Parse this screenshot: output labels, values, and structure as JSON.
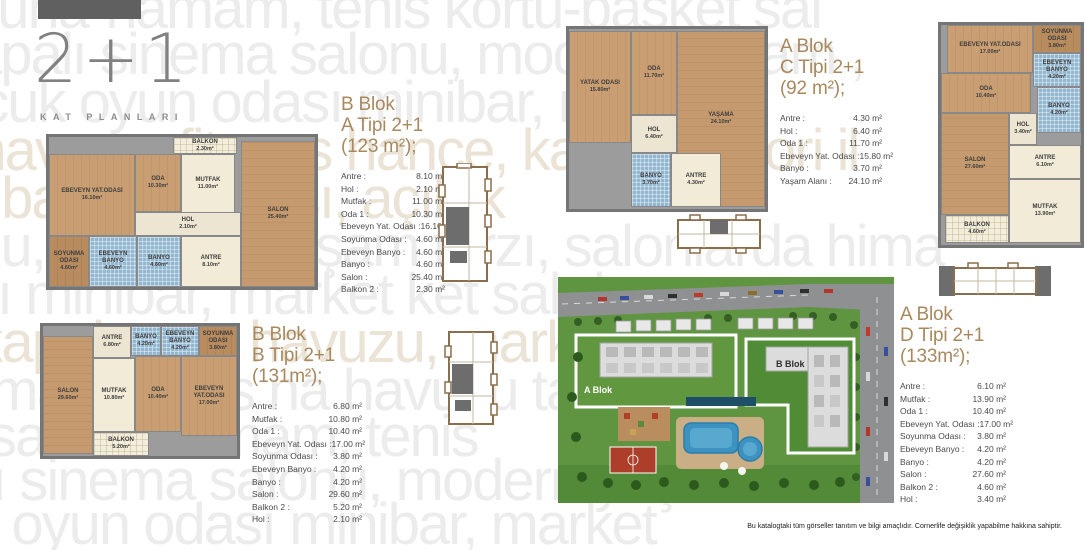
{
  "brand": {
    "title": "2+1",
    "subtitle": "KAT PLANLARI"
  },
  "watermark": {
    "lines": [
      "sauna-hamam, tenis kortu-basket sal",
      "apalı sinema salonu, modern yaşam ,",
      "ocuk oyun odası minibar, mer",
      "e havuzu, fitness hance, kapalı otolori il",
      "k basket sahası, açık-k",
      "onu, modern yaşam tarzı, salonlarda hima",
      "sı minibar, market ket sah kam",
      "k-kapalı zme havuzu, market, ket saha",
      "amam, tenis na havuzu tarzı sal",
      "ss sauna-hamam, tenis",
      "alı sinema salonu, modern yaşam",
      "uk oyun odası minibar, market"
    ]
  },
  "units": [
    {
      "block": "B Blok",
      "type": "A Tipi 2+1 (123 m²);",
      "rooms": [
        {
          "label": "Antre :",
          "value": "8.10 m²"
        },
        {
          "label": "Hol :",
          "value": "2.10 m²"
        },
        {
          "label": "Mutfak :",
          "value": "11.00 m²"
        },
        {
          "label": "Oda 1 :",
          "value": "10.30 m²"
        },
        {
          "label": "Ebeveyn Yat. Odası :",
          "value": "16.10 m²"
        },
        {
          "label": "Soyunma Odası :",
          "value": "4.60 m²"
        },
        {
          "label": "Ebeveyn Banyo :",
          "value": "4.60 m²"
        },
        {
          "label": "Banyo :",
          "value": "4.60 m²"
        },
        {
          "label": "Salon :",
          "value": "25.40 m²"
        },
        {
          "label": "Balkon 2 :",
          "value": "2.30 m²"
        }
      ]
    },
    {
      "block": "A Blok",
      "type": "C Tipi 2+1 (92 m²);",
      "rooms": [
        {
          "label": "Antre :",
          "value": "4.30 m²"
        },
        {
          "label": "Hol :",
          "value": "6.40 m²"
        },
        {
          "label": "Oda 1 :",
          "value": "11.70 m²"
        },
        {
          "label": "Ebeveyn Yat. Odası :",
          "value": "15.80 m²"
        },
        {
          "label": "Banyo :",
          "value": "3.70 m²"
        },
        {
          "label": "Yaşam Alanı :",
          "value": "24.10 m²"
        }
      ]
    },
    {
      "block": "B Blok",
      "type": "B Tipi 2+1 (131m²);",
      "rooms": [
        {
          "label": "Antre :",
          "value": "6.80 m²"
        },
        {
          "label": "Mutfak :",
          "value": "10.80 m²"
        },
        {
          "label": "Oda 1 :",
          "value": "10.40 m²"
        },
        {
          "label": "Ebeveyn Yat. Odası :",
          "value": "17.00 m²"
        },
        {
          "label": "Soyunma Odası :",
          "value": "3.80 m²"
        },
        {
          "label": "Ebeveyn Banyo :",
          "value": "4.20 m²"
        },
        {
          "label": "Banyo :",
          "value": "4.20 m²"
        },
        {
          "label": "Salon :",
          "value": "29.60 m²"
        },
        {
          "label": "Balkon 2 :",
          "value": "5.20 m²"
        },
        {
          "label": "Hol :",
          "value": "2.10 m²"
        }
      ]
    },
    {
      "block": "A Blok",
      "type": "D Tipi 2+1 (133m²);",
      "rooms": [
        {
          "label": "Antre :",
          "value": "6.10 m²"
        },
        {
          "label": "Mutfak :",
          "value": "13.90 m²"
        },
        {
          "label": "Oda 1 :",
          "value": "10.40 m²"
        },
        {
          "label": "Ebeveyn Yat. Odası :",
          "value": "17.00 m²"
        },
        {
          "label": "Soyunma Odası :",
          "value": "3.80 m²"
        },
        {
          "label": "Ebeveyn Banyo :",
          "value": "4.20 m²"
        },
        {
          "label": "Banyo :",
          "value": "4.20 m²"
        },
        {
          "label": "Salon :",
          "value": "27.60 m²"
        },
        {
          "label": "Balkon 2 :",
          "value": "4.60 m²"
        },
        {
          "label": "Hol :",
          "value": "3.40 m²"
        }
      ]
    }
  ],
  "plans": [
    {
      "name": "B Blok A Tipi plan",
      "rooms": [
        {
          "name": "BALKON",
          "area": "2.30m²"
        },
        {
          "name": "EBEVEYN YAT.ODASI",
          "area": "16.10m²"
        },
        {
          "name": "ODA",
          "area": "10.30m²"
        },
        {
          "name": "MUTFAK",
          "area": "11.00m²"
        },
        {
          "name": "SALON",
          "area": "25.40m²"
        },
        {
          "name": "HOL",
          "area": "2.10m²"
        },
        {
          "name": "SOYUNMA ODASI",
          "area": "4.60m²"
        },
        {
          "name": "EBEVEYN BANYO",
          "area": "4.60m²"
        },
        {
          "name": "BANYO",
          "area": "4.60m²"
        },
        {
          "name": "ANTRE",
          "area": "8.10m²"
        }
      ]
    },
    {
      "name": "A Blok C Tipi plan",
      "rooms": [
        {
          "name": "YATAK ODASI",
          "area": "15.80m²"
        },
        {
          "name": "ODA",
          "area": "11.70m²"
        },
        {
          "name": "YAŞAMA",
          "area": "24.10m²"
        },
        {
          "name": "HOL",
          "area": "6.40m²"
        },
        {
          "name": "BANYO",
          "area": "3.70m²"
        },
        {
          "name": "ANTRE",
          "area": "4.30m²"
        }
      ]
    },
    {
      "name": "A Blok D Tipi plan",
      "rooms": [
        {
          "name": "EBEVEYN YAT.ODASI",
          "area": "17.00m²"
        },
        {
          "name": "SOYUNMA ODASI",
          "area": "3.80m²"
        },
        {
          "name": "EBEVEYN BANYO",
          "area": "4.20m²"
        },
        {
          "name": "ODA",
          "area": "10.40m²"
        },
        {
          "name": "HOL",
          "area": "3.40m²"
        },
        {
          "name": "BANYO",
          "area": "4.20m²"
        },
        {
          "name": "SALON",
          "area": "27.60m²"
        },
        {
          "name": "ANTRE",
          "area": "6.10m²"
        },
        {
          "name": "MUTFAK",
          "area": "13.90m²"
        },
        {
          "name": "BALKON",
          "area": "4.60m²"
        }
      ]
    },
    {
      "name": "B Blok B Tipi plan",
      "rooms": [
        {
          "name": "ANTRE",
          "area": "6.80m²"
        },
        {
          "name": "BANYO",
          "area": "4.20m²"
        },
        {
          "name": "EBEVEYN BANYO",
          "area": "4.20m²"
        },
        {
          "name": "SOYUNMA ODASI",
          "area": "3.80m²"
        },
        {
          "name": "SALON",
          "area": "29.60m²"
        },
        {
          "name": "MUTFAK",
          "area": "10.80m²"
        },
        {
          "name": "ODA",
          "area": "10.40m²"
        },
        {
          "name": "EBEVEYN YAT.ODASI",
          "area": "17.00m²"
        },
        {
          "name": "BALKON",
          "area": "5.20m²"
        }
      ]
    }
  ],
  "site": {
    "label_a": "A Blok",
    "label_b": "B Blok"
  },
  "footer": {
    "disclaimer": "Bu katalogtaki tüm görseller tanıtım ve bilgi amaçlıdır. Cornerlife değişiklik yapabilme hakkına sahiptir."
  },
  "colors": {
    "heading": "#a8895e",
    "wall": "#757575",
    "wood": "#c99e73",
    "tile": "#92b7d0",
    "grass": "#5f9440",
    "pool": "#3c93c1",
    "court": "#ad3f2a"
  }
}
